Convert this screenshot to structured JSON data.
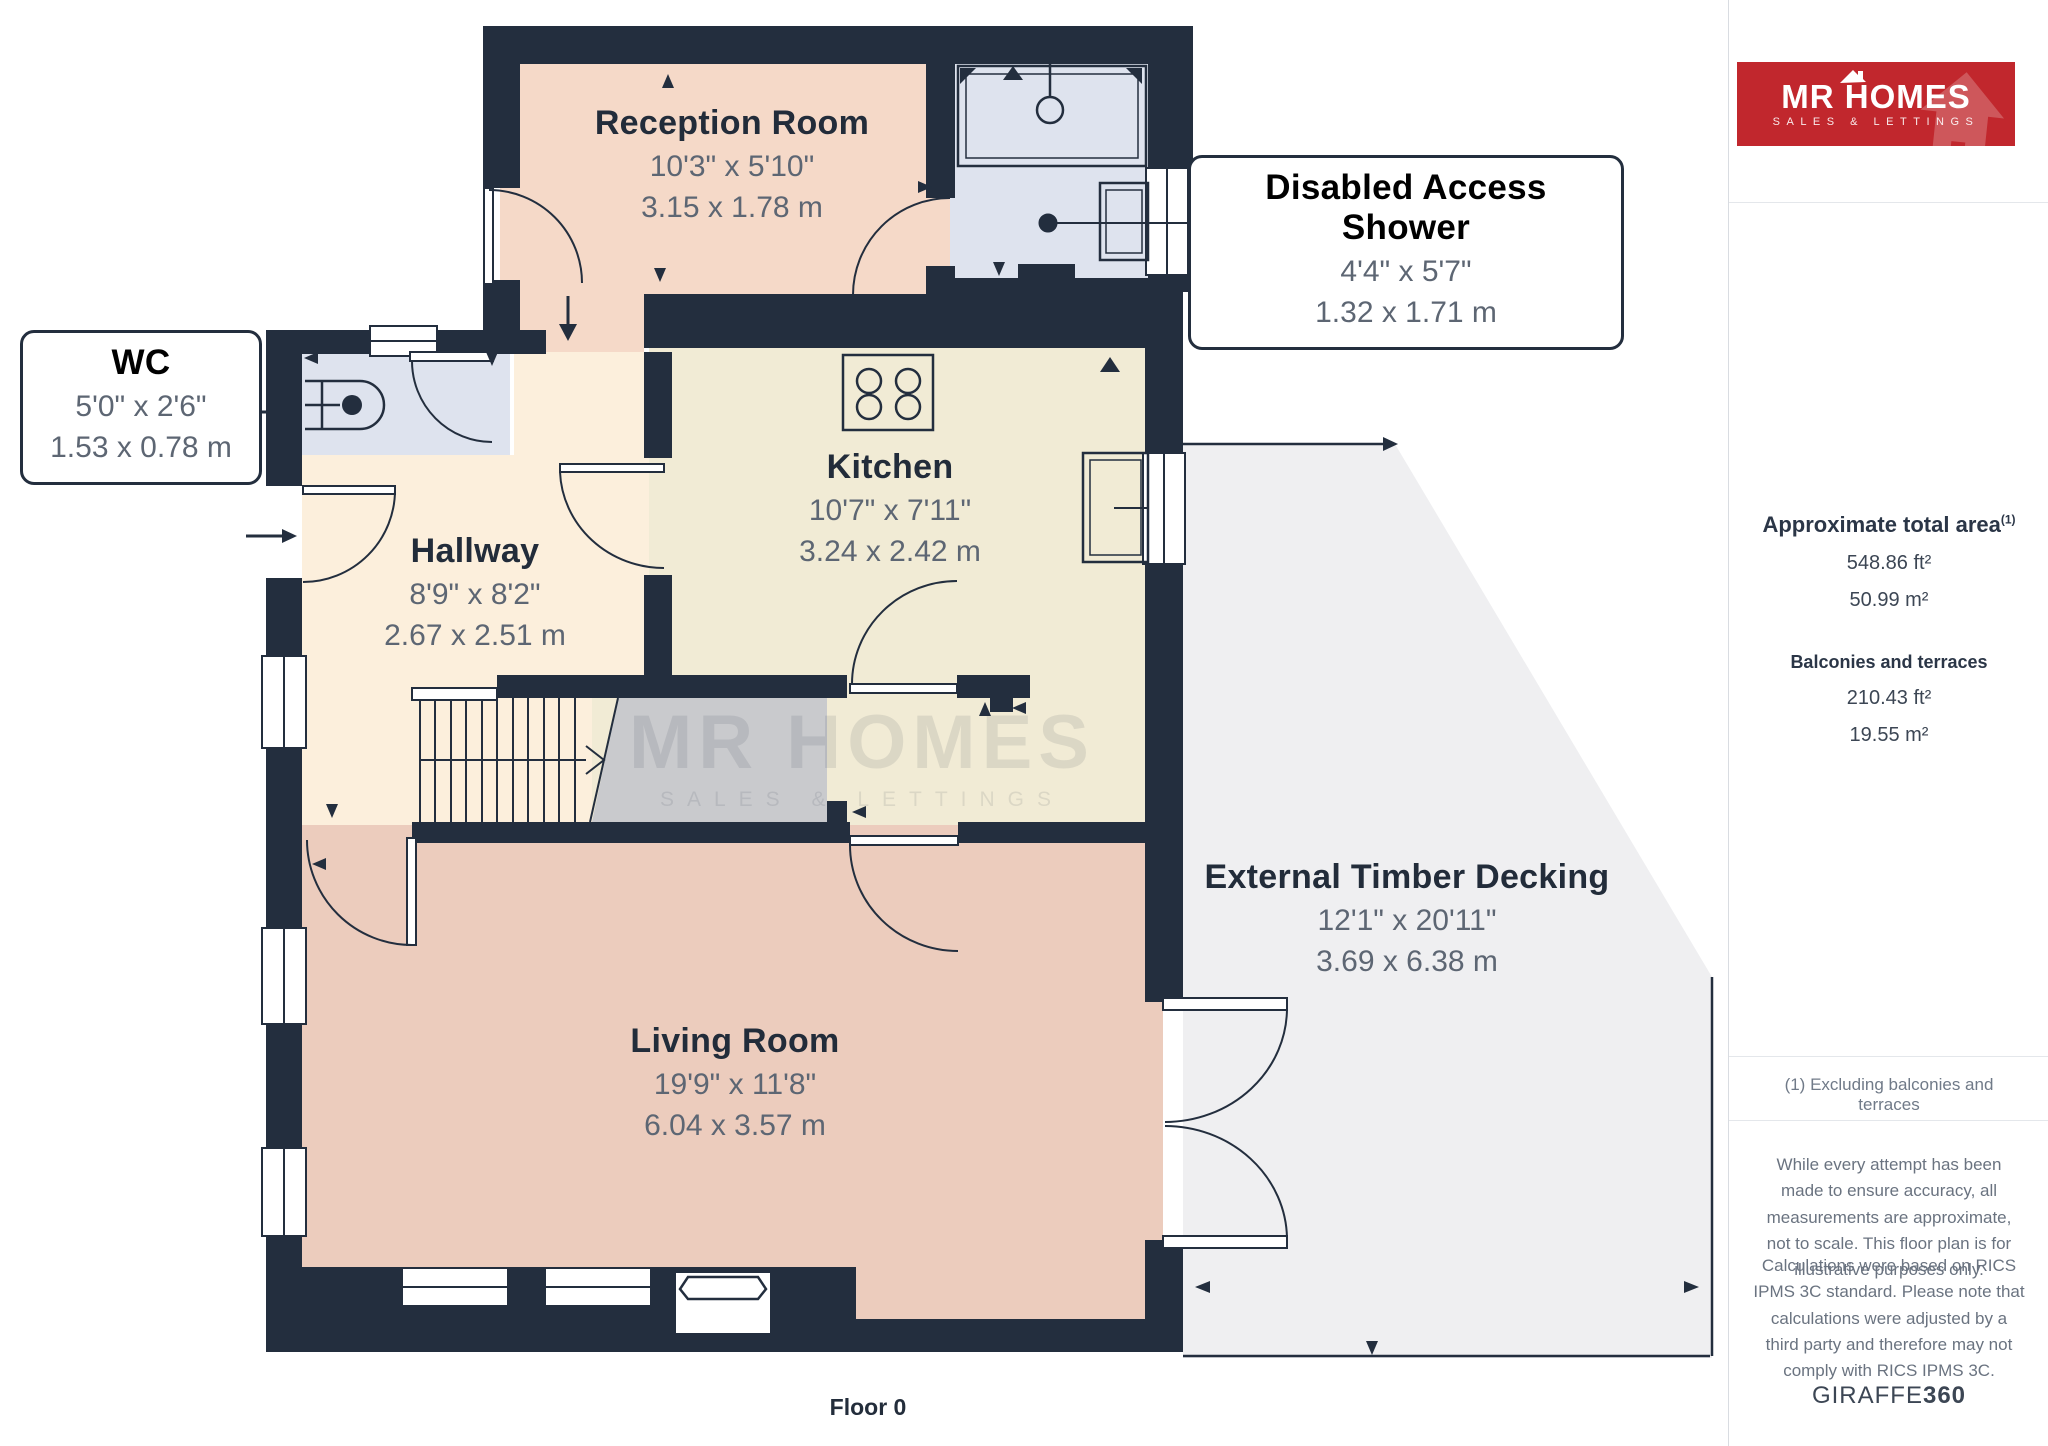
{
  "plan": {
    "floor_label": "Floor 0",
    "watermark": {
      "line1": "MR HOMES",
      "line2": "SALES & LETTINGS"
    },
    "rooms": [
      {
        "name": "Reception Room",
        "imperial": "10'3\" x 5'10\"",
        "metric": "3.15 x 1.78 m"
      },
      {
        "name": "Kitchen",
        "imperial": "10'7\" x 7'11\"",
        "metric": "3.24 x 2.42 m"
      },
      {
        "name": "Hallway",
        "imperial": "8'9\" x 8'2\"",
        "metric": "2.67 x 2.51 m"
      },
      {
        "name": "Living Room",
        "imperial": "19'9\" x 11'8\"",
        "metric": "6.04 x 3.57 m"
      },
      {
        "name": "External Timber Decking",
        "imperial": "12'1\" x 20'11\"",
        "metric": "3.69 x 6.38 m"
      }
    ],
    "callouts": [
      {
        "name": "WC",
        "imperial": "5'0\" x 2'6\"",
        "metric": "1.53 x 0.78 m"
      },
      {
        "name": "Disabled Access Shower",
        "imperial": "4'4\" x 5'7\"",
        "metric": "1.32 x 1.71 m"
      }
    ],
    "colors": {
      "wall": "#232e3e",
      "reception": "#f5d9c8",
      "living": "#ecccbd",
      "hallway": "#fcefdc",
      "kitchen": "#f1ebd5",
      "bathroom": "#dee3ee",
      "stair_void": "#c9cacd",
      "decking": "#efeff1"
    }
  },
  "sidebar": {
    "logo": {
      "line1": "MR HOMES",
      "line2": "SALES & LETTINGS",
      "red": "#c1272d"
    },
    "areas": {
      "title": "Approximate total area",
      "title_sup": "(1)",
      "total_ft": "548.86 ft²",
      "total_m": "50.99 m²",
      "balconies_title": "Balconies and terraces",
      "balconies_ft": "210.43 ft²",
      "balconies_m": "19.55 m²"
    },
    "footnote": "(1) Excluding balconies and terraces",
    "disclaimer_1": "While every attempt has been made to ensure accuracy, all measurements are approximate, not to scale. This floor plan is for illustrative purposes only.",
    "disclaimer_2": "Calculations were based on RICS IPMS 3C standard. Please note that calculations were adjusted by a third party and therefore may not comply with RICS IPMS 3C.",
    "brand": {
      "name": "GIRAFFE",
      "suffix": "360"
    }
  }
}
